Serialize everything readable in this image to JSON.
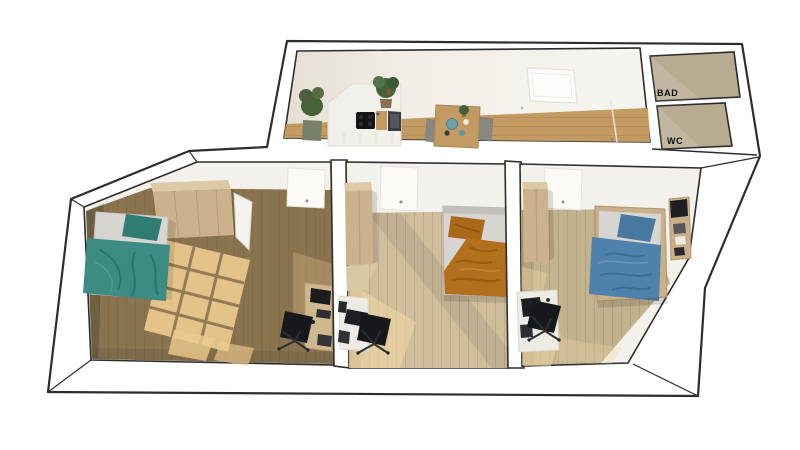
{
  "labels": {
    "bathroom": "BAD",
    "toilet": "WC"
  },
  "colors": {
    "outline": "#2d2d2d",
    "wall_white": "#ffffff",
    "wall_face": "#f3f1ec",
    "bathroom_floor": "#b7ab91",
    "kitchen_floor_wood": "#c49a63",
    "bedroom1_floor": "#8a7450",
    "bedroom2_floor": "#cfbd9b",
    "bedroom3_floor": "#c3b28e",
    "sunlight": "#eed6a4",
    "sunlight_strong": "#ecca8e",
    "wardrobe_tan": "#cbb28c",
    "bed_teal": "#3d8c84",
    "bed_orange": "#b26f1c",
    "bed_blue": "#4e82aa",
    "mattress_gray": "#d6d5d1",
    "desk_white": "#edebe4",
    "chair_black": "#17181b",
    "table_wood": "#c49a63",
    "plant_green": "#45633a"
  }
}
